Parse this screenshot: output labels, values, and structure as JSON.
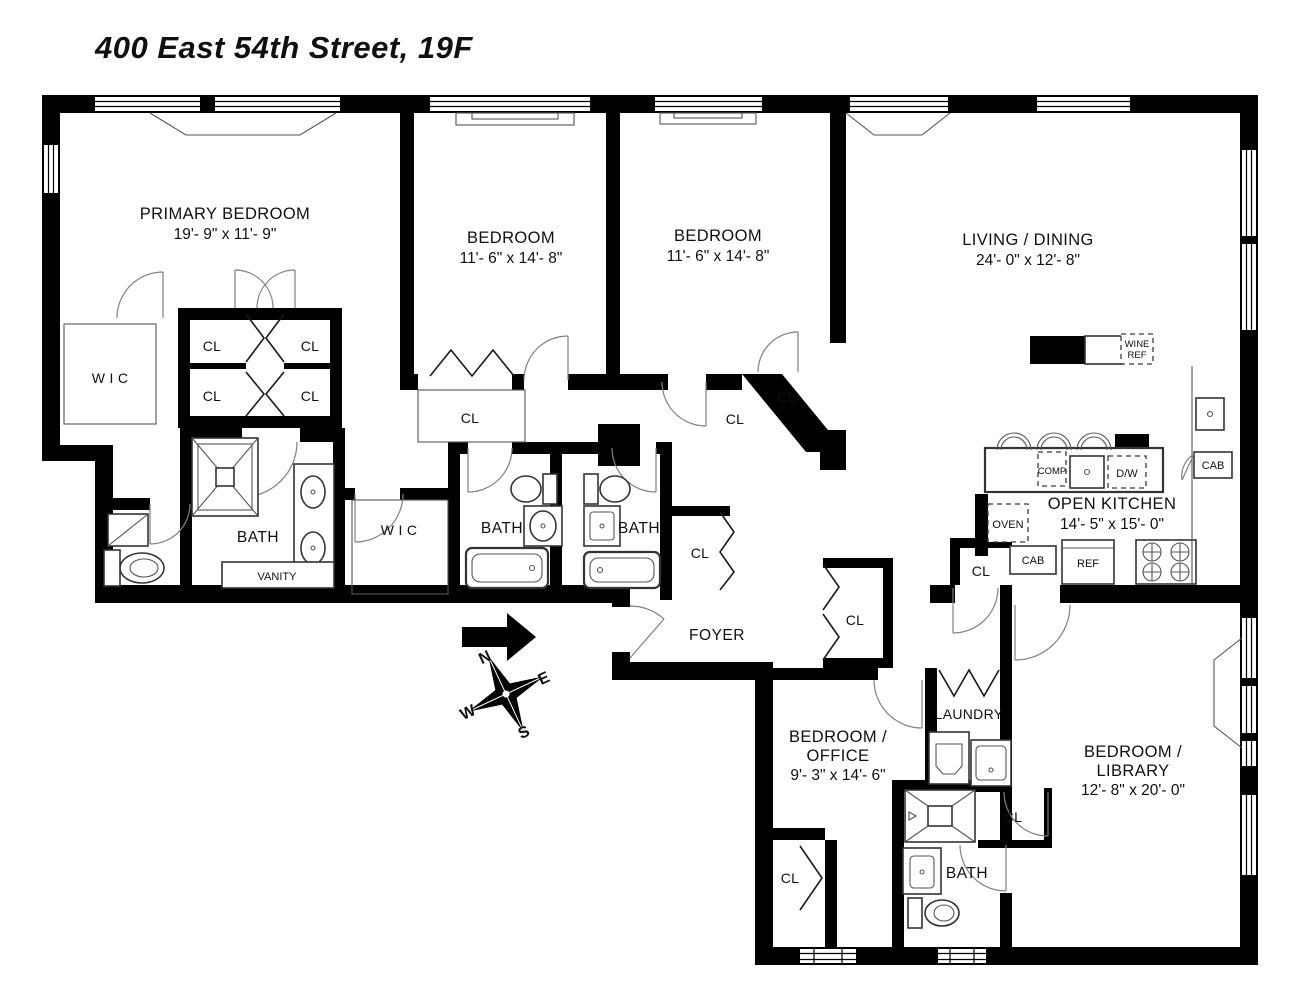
{
  "title": "400 East 54th Street, 19F",
  "rooms": {
    "primary_bedroom": {
      "name": "PRIMARY BEDROOM",
      "dims": "19'- 9\" x 11'- 9\""
    },
    "bedroom_1": {
      "name": "BEDROOM",
      "dims": "11'- 6\" x 14'- 8\""
    },
    "bedroom_2": {
      "name": "BEDROOM",
      "dims": "11'- 6\" x 14'- 8\""
    },
    "living_dining": {
      "name": "LIVING / DINING",
      "dims": "24'- 0\" x 12'- 8\""
    },
    "open_kitchen": {
      "name": "OPEN KITCHEN",
      "dims": "14'- 5\" x 15'- 0\""
    },
    "bedroom_office": {
      "name_line1": "BEDROOM /",
      "name_line2": "OFFICE",
      "dims": "9'- 3\" x 14'- 6\""
    },
    "bedroom_library": {
      "name_line1": "BEDROOM /",
      "name_line2": "LIBRARY",
      "dims": "12'- 8\" x 20'- 0\""
    },
    "foyer": {
      "name": "FOYER"
    },
    "laundry": {
      "name": "LAUNDRY"
    }
  },
  "labels": {
    "bath": "BATH",
    "vanity": "VANITY",
    "wic": "W I C",
    "cl": "CL",
    "cab": "CAB",
    "ref": "REF",
    "oven": "OVEN",
    "comp": "COMP",
    "dw": "D/W",
    "wine_line1": "WINE",
    "wine_line2": "REF"
  },
  "compass": {
    "north": "N",
    "east": "E",
    "south": "S",
    "west": "W"
  },
  "colors": {
    "walls": "#000000",
    "background": "#ffffff",
    "line_detail": "#555555"
  }
}
